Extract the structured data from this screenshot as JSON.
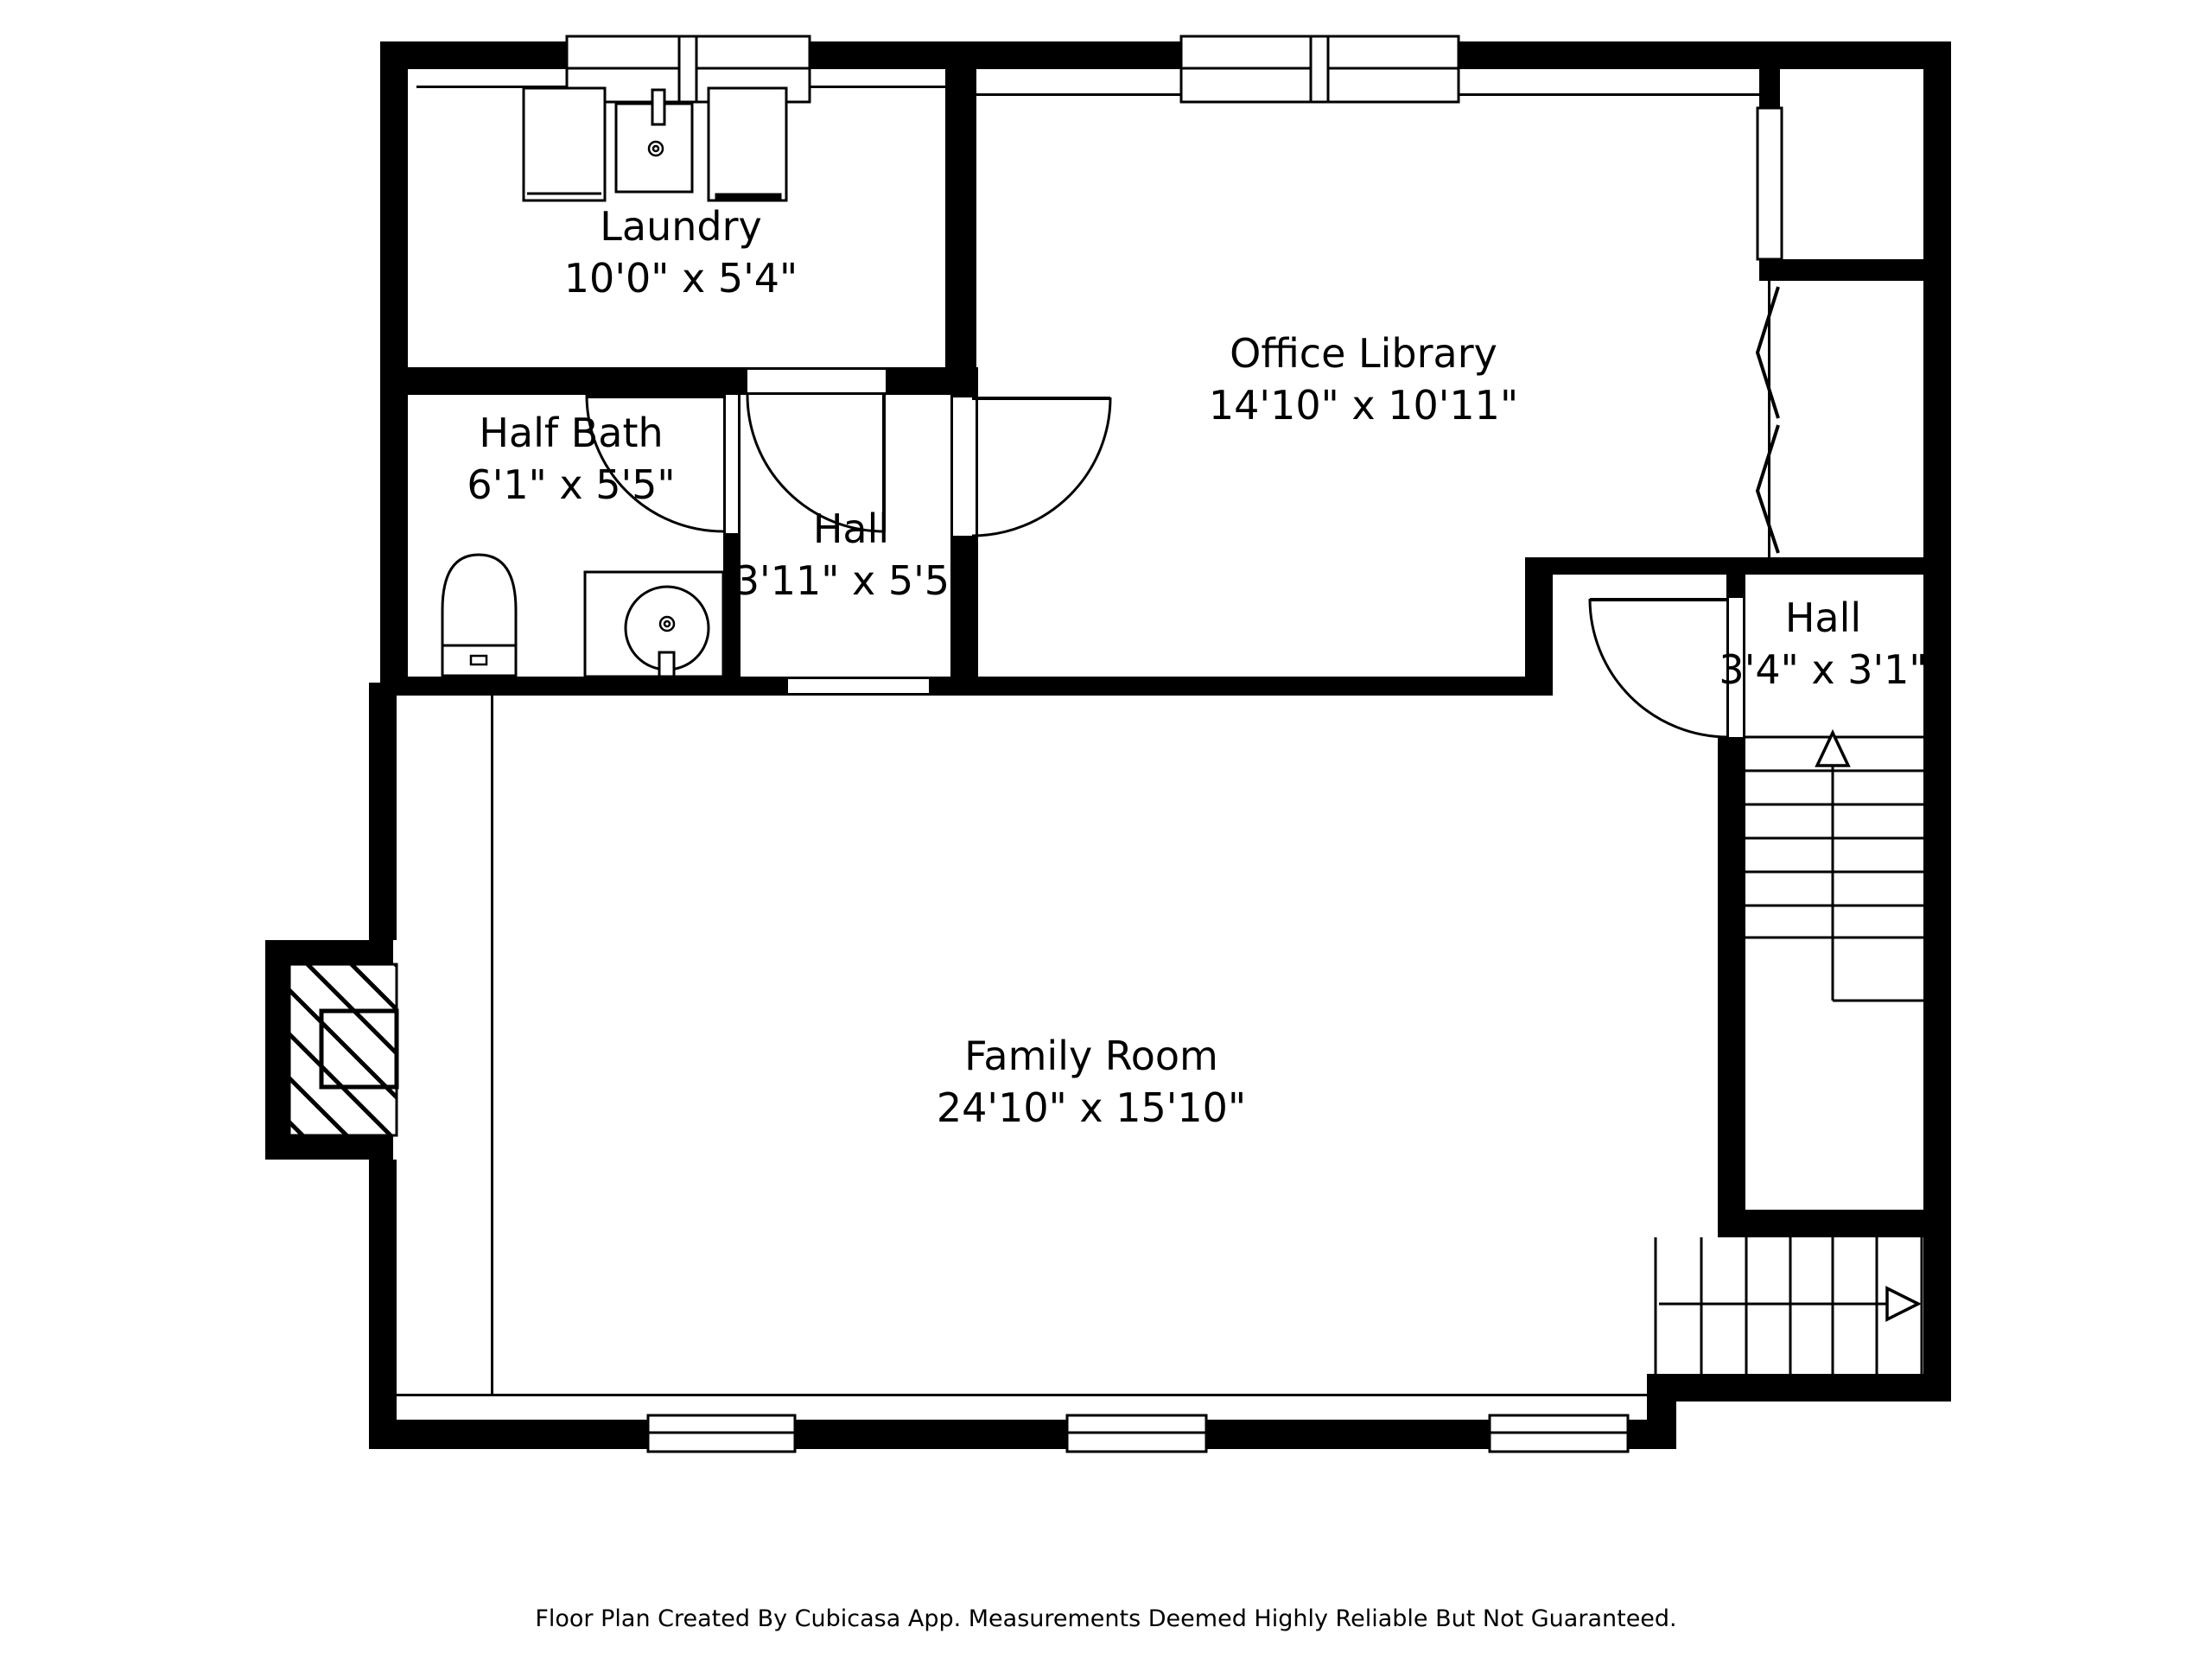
{
  "rooms": {
    "laundry": {
      "name": "Laundry",
      "dims": "10'0\" x 5'4\""
    },
    "half_bath": {
      "name": "Half Bath",
      "dims": "6'1\" x 5'5\""
    },
    "hall_center": {
      "name": "Hall",
      "dims": "3'11\" x 5'5\""
    },
    "office_library": {
      "name": "Office Library",
      "dims": "14'10\" x 10'11\""
    },
    "family_room": {
      "name": "Family Room",
      "dims": "24'10\" x 15'10\""
    },
    "hall_right": {
      "name": "Hall",
      "dims": "3'4\" x 3'1\""
    }
  },
  "footer": {
    "text": "Floor Plan Created By Cubicasa App. Measurements Deemed Highly Reliable But Not Guaranteed."
  },
  "icons": {
    "stairs_up_arrow": "↑",
    "stairs_down_arrow": "→"
  },
  "colors": {
    "wall": "#000000",
    "background": "#ffffff",
    "line": "#000000",
    "text": "#000000"
  }
}
